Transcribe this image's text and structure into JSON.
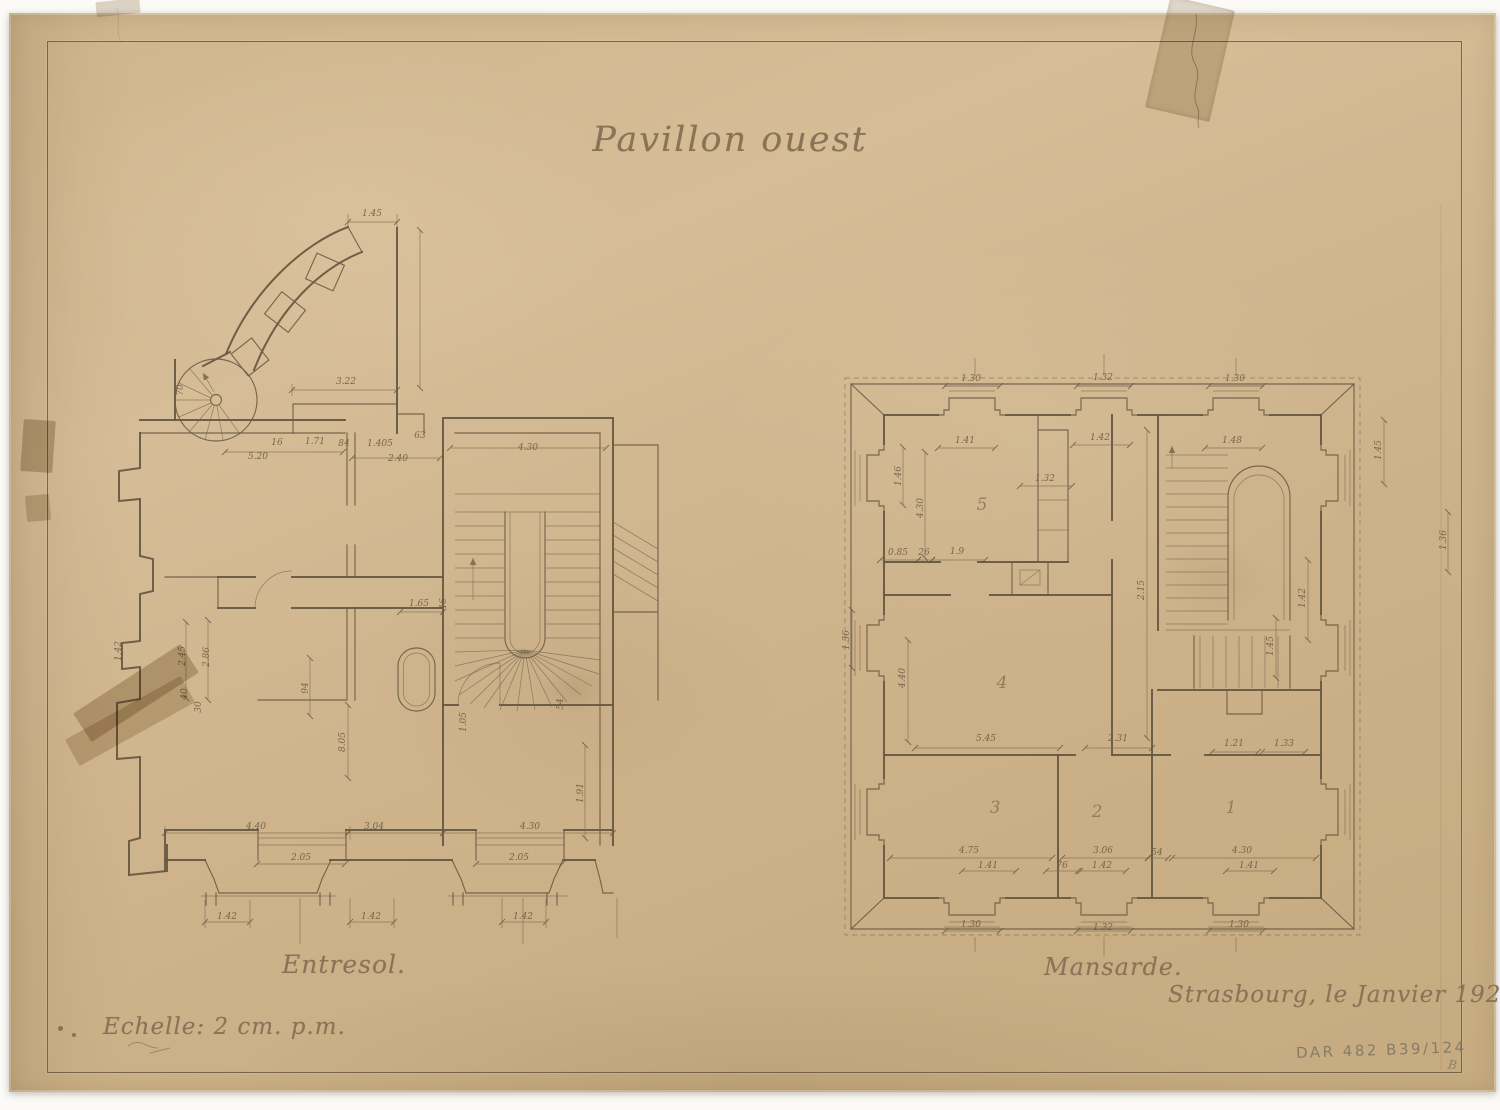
{
  "sheet": {
    "title": "Pavillon ouest",
    "scale_note": "Echelle: 2 cm. p.m.",
    "place_date": "Strasbourg, le Janvier 1920.",
    "archive_stamp": "DAR 482 B39/124",
    "corner_mark": "B",
    "paper_color": "#cfb58d",
    "ink_color": "#675741",
    "pencil_color": "#8d8475"
  },
  "plans": [
    {
      "id": "entresol",
      "label": "Entresol."
    },
    {
      "id": "mansarde",
      "label": "Mansarde."
    }
  ],
  "annotations": {
    "entresol": [
      {
        "t": "1.45",
        "x": 372,
        "y": 216
      },
      {
        "t": "3.22",
        "x": 346,
        "y": 384
      },
      {
        "t": "63",
        "x": 420,
        "y": 438
      },
      {
        "t": "16",
        "x": 277,
        "y": 445
      },
      {
        "t": "1.71",
        "x": 315,
        "y": 444
      },
      {
        "t": "84",
        "x": 344,
        "y": 446
      },
      {
        "t": "1.405",
        "x": 380,
        "y": 446
      },
      {
        "t": "5.20",
        "x": 258,
        "y": 459
      },
      {
        "t": "2.40",
        "x": 398,
        "y": 461
      },
      {
        "t": "70",
        "x": 183,
        "y": 390,
        "r": -90
      },
      {
        "t": "2.45",
        "x": 185,
        "y": 656,
        "r": -90
      },
      {
        "t": "2.86",
        "x": 209,
        "y": 657,
        "r": -90
      },
      {
        "t": "1.42",
        "x": 121,
        "y": 651,
        "r": -90
      },
      {
        "t": "40",
        "x": 187,
        "y": 694,
        "r": -90
      },
      {
        "t": "30",
        "x": 201,
        "y": 707,
        "r": -90
      },
      {
        "t": "94",
        "x": 308,
        "y": 688,
        "r": -90
      },
      {
        "t": "8.05",
        "x": 345,
        "y": 742,
        "r": -90
      },
      {
        "t": "1.65",
        "x": 419,
        "y": 606
      },
      {
        "t": "46",
        "x": 446,
        "y": 604,
        "r": -90
      },
      {
        "t": "4.30",
        "x": 528,
        "y": 450
      },
      {
        "t": "1.05",
        "x": 466,
        "y": 722,
        "r": -90
      },
      {
        "t": "54",
        "x": 563,
        "y": 704,
        "r": -90
      },
      {
        "t": "1.91",
        "x": 583,
        "y": 793,
        "r": -90
      },
      {
        "t": "4.40",
        "x": 256,
        "y": 829
      },
      {
        "t": "3.04",
        "x": 374,
        "y": 829
      },
      {
        "t": "4.30",
        "x": 530,
        "y": 829
      },
      {
        "t": "2.05",
        "x": 301,
        "y": 860
      },
      {
        "t": "2.05",
        "x": 519,
        "y": 860
      },
      {
        "t": "1.42",
        "x": 227,
        "y": 919
      },
      {
        "t": "1.42",
        "x": 371,
        "y": 919
      },
      {
        "t": "1.42",
        "x": 523,
        "y": 919
      }
    ],
    "mansarde": [
      {
        "t": "1.30",
        "x": 971,
        "y": 381
      },
      {
        "t": "1.32",
        "x": 1103,
        "y": 380
      },
      {
        "t": "1.30",
        "x": 1235,
        "y": 381
      },
      {
        "t": "1.41",
        "x": 965,
        "y": 443
      },
      {
        "t": "1.42",
        "x": 1100,
        "y": 440
      },
      {
        "t": "1.48",
        "x": 1232,
        "y": 443
      },
      {
        "t": "1.32",
        "x": 1045,
        "y": 481
      },
      {
        "t": "1.46",
        "x": 901,
        "y": 476,
        "r": -90
      },
      {
        "t": "4.30",
        "x": 923,
        "y": 508,
        "r": -90
      },
      {
        "t": "0.85",
        "x": 898,
        "y": 555
      },
      {
        "t": "26",
        "x": 924,
        "y": 555
      },
      {
        "t": "1.9",
        "x": 957,
        "y": 554
      },
      {
        "t": "2.15",
        "x": 1144,
        "y": 590,
        "r": -90
      },
      {
        "t": "4.40",
        "x": 905,
        "y": 678,
        "r": -90
      },
      {
        "t": "1.36",
        "x": 849,
        "y": 640,
        "r": -90
      },
      {
        "t": "5.45",
        "x": 986,
        "y": 741
      },
      {
        "t": "2.31",
        "x": 1118,
        "y": 741
      },
      {
        "t": "1.21",
        "x": 1234,
        "y": 746
      },
      {
        "t": "1.33",
        "x": 1284,
        "y": 746
      },
      {
        "t": "4.75",
        "x": 969,
        "y": 853
      },
      {
        "t": "3.06",
        "x": 1103,
        "y": 853
      },
      {
        "t": "54",
        "x": 1157,
        "y": 855
      },
      {
        "t": "4.30",
        "x": 1242,
        "y": 853
      },
      {
        "t": "1.41",
        "x": 988,
        "y": 868
      },
      {
        "t": "76",
        "x": 1062,
        "y": 868
      },
      {
        "t": "1.42",
        "x": 1102,
        "y": 868
      },
      {
        "t": "1.41",
        "x": 1249,
        "y": 868
      },
      {
        "t": "1.30",
        "x": 971,
        "y": 927
      },
      {
        "t": "1.32",
        "x": 1103,
        "y": 930
      },
      {
        "t": "1.30",
        "x": 1239,
        "y": 927
      },
      {
        "t": "1.45",
        "x": 1381,
        "y": 450,
        "r": -90
      },
      {
        "t": "1.36",
        "x": 1446,
        "y": 540,
        "r": -90
      },
      {
        "t": "1.42",
        "x": 1305,
        "y": 598,
        "r": -90
      },
      {
        "t": "1.45",
        "x": 1273,
        "y": 646,
        "r": -90
      }
    ],
    "room_numbers": [
      {
        "t": "5",
        "x": 982,
        "y": 510
      },
      {
        "t": "4",
        "x": 1002,
        "y": 688
      },
      {
        "t": "3",
        "x": 995,
        "y": 813
      },
      {
        "t": "2",
        "x": 1097,
        "y": 817
      },
      {
        "t": "1",
        "x": 1231,
        "y": 813
      }
    ]
  }
}
